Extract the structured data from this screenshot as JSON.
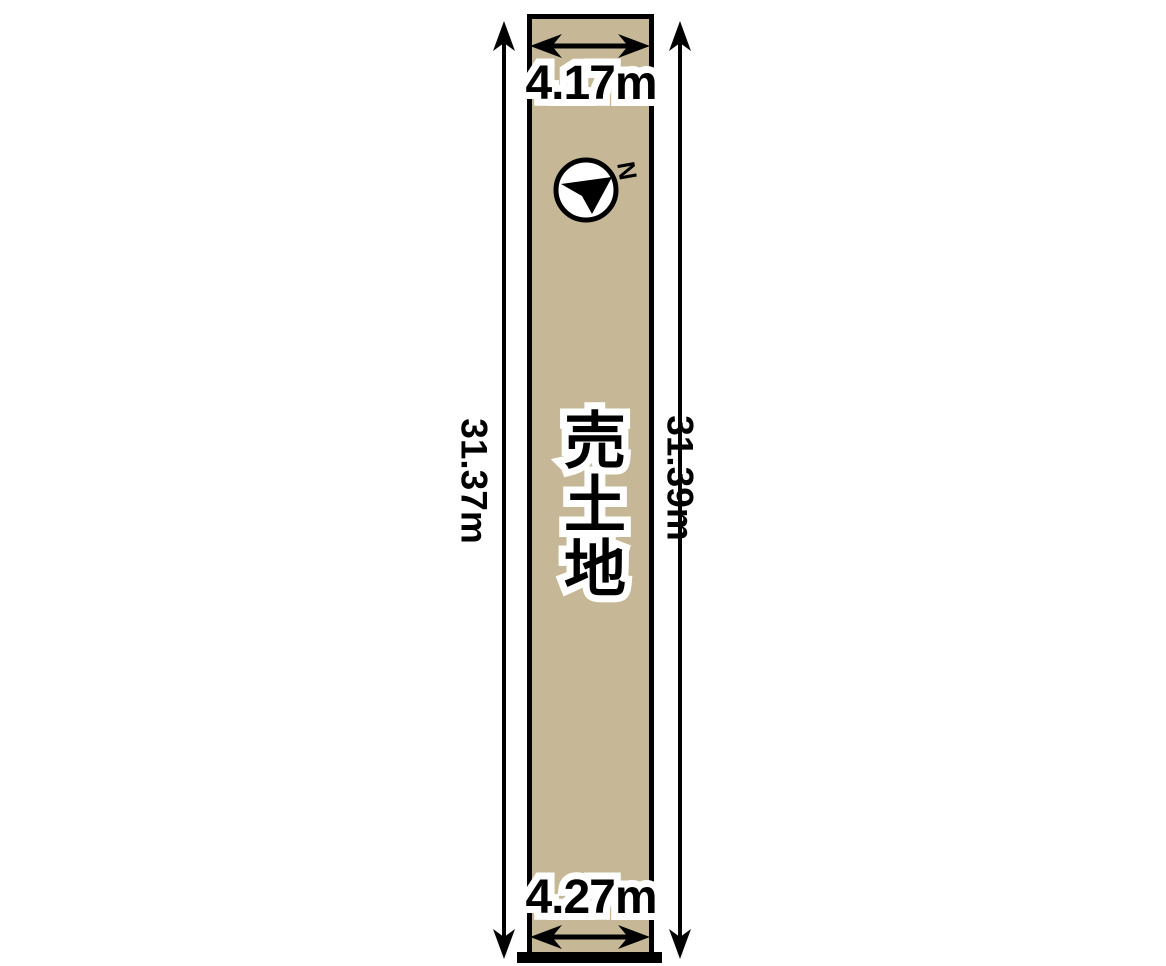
{
  "site_plan": {
    "parcel_label": "売土地",
    "dimensions": {
      "top_width": "4.17m",
      "bottom_width": "4.27m",
      "left_depth": "31.37m",
      "right_depth": "31.39m"
    },
    "compass": {
      "north_label": "N"
    },
    "colors": {
      "parcel_fill": "#c6b897",
      "line_color": "#000000",
      "background": "#ffffff",
      "label_text": "#000000",
      "label_outline": "#ffffff",
      "compass_fill": "#ffffff"
    }
  }
}
